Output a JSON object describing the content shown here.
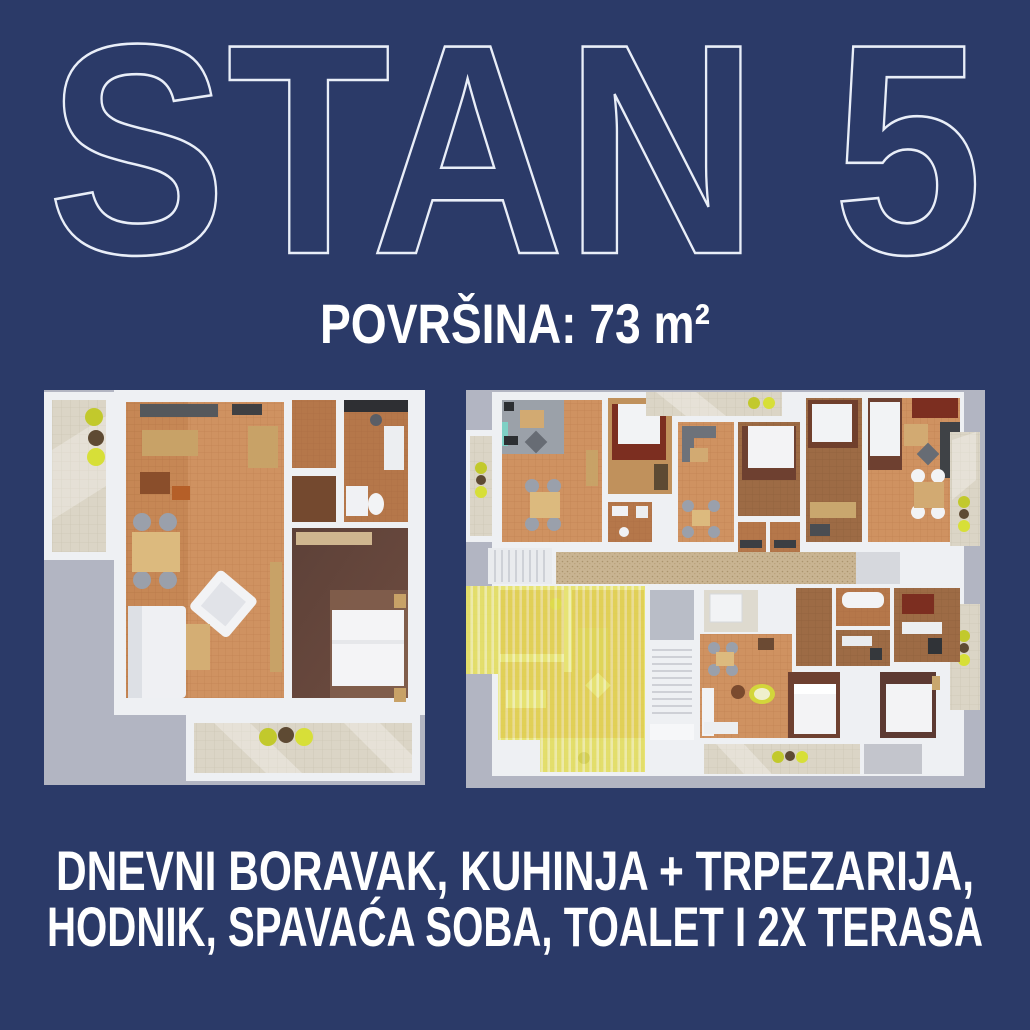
{
  "poster": {
    "title": "STAN 5",
    "area_label": "POVRŠINA: 73 m²",
    "description_line1": "DNEVNI BORAVAK, KUHINJA + TRPEZARIJA,",
    "description_line2": "HODNIK, SPAVAĆA SOBA, TOALET I 2X TERASA"
  },
  "floorplans": {
    "left_render": "apartment-3d-floorplan",
    "right_render": "building-floor-overview",
    "highlighted_unit": "stan-5-yellow-highlight"
  },
  "colors": {
    "background_navy": "#2b3a68",
    "title_outline": "#e9eef8",
    "text_white": "#ffffff",
    "plan_backdrop_gray": "#b2b5c2",
    "wall_white": "#eef0f3",
    "floor_terracotta": "#cf9261",
    "floor_cork": "#b5774a",
    "bedroom_carpet": "#5d4138",
    "terrace_tile": "#dbd5c6",
    "highlight_yellow": "#e5e054",
    "stool_yellow": "#c2c92c"
  }
}
